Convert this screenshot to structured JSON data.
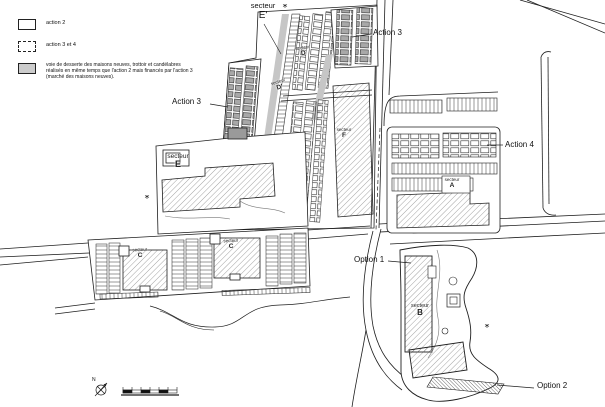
{
  "legend": {
    "items": [
      {
        "id": "action2",
        "swatch": "outline",
        "label": "action 2"
      },
      {
        "id": "action34",
        "swatch": "dashed",
        "label": "action 3 et 4"
      },
      {
        "id": "voie",
        "swatch": "gray",
        "label": "voie de desserte des maisons neuves, trottoir et candélabres réalisés en même temps que l'action 2 mais financés par l'action 3 (marché des maisons neuves)."
      }
    ]
  },
  "callouts": {
    "action3_west": "Action 3",
    "action3_north": "Action 3",
    "action4": "Action 4",
    "option1": "Option 1",
    "option2": "Option 2"
  },
  "sectors": {
    "e_prime": {
      "word": "secteur",
      "letter": "E'"
    },
    "d": {
      "word": "secteur",
      "letter": "D"
    },
    "d_prime": {
      "word": "secteur",
      "letter": "D'"
    },
    "f": {
      "word": "secteur",
      "letter": "F"
    },
    "e": {
      "word": "secteur",
      "letter": "E"
    },
    "a": {
      "word": "secteur",
      "letter": "A"
    },
    "c_west": {
      "word": "secteur",
      "letter": "C"
    },
    "c_east": {
      "word": "secteur",
      "letter": "C"
    },
    "b": {
      "word": "secteur",
      "letter": "B"
    }
  },
  "compass": {
    "north": "N"
  },
  "colors": {
    "line": "#1f1f1f",
    "gray_road": "#c6c6c6",
    "gray_house": "#a8a8a8",
    "legend_gray": "#cccccc",
    "hatch": "#555555"
  }
}
